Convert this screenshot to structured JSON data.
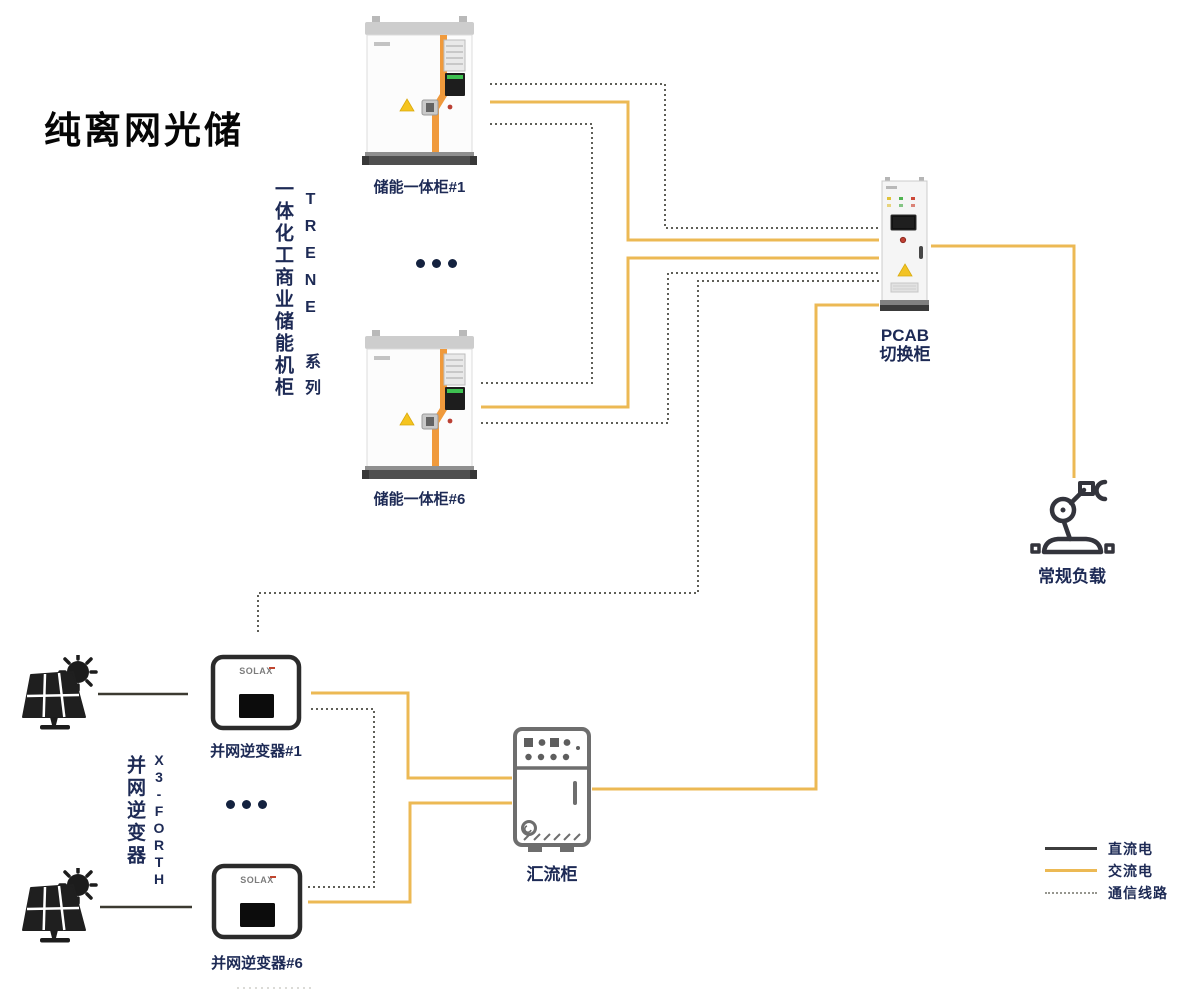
{
  "title": "纯离网光储",
  "colors": {
    "ac": "#ecb954",
    "dc": "#3c3a31",
    "dc_legend": "#3d3d3d",
    "comm": "#5f5f58",
    "comm_legend": "#96968f",
    "navy": "#1d2a55",
    "orange": "#f09a3c"
  },
  "series_blocks": {
    "storage": {
      "name": "一体化工商业储能机柜",
      "series": "TRENE 系列"
    },
    "inverter": {
      "model": "X3-FORTH",
      "name": "并网逆变器"
    }
  },
  "nodes": {
    "storage_cabinet_1": {
      "label": "储能一体柜#1"
    },
    "storage_cabinet_6": {
      "label": "储能一体柜#6"
    },
    "pcab": {
      "label_line1": "PCAB",
      "label_line2": "切换柜"
    },
    "load": {
      "label": "常规负载"
    },
    "combiner": {
      "label": "汇流柜"
    },
    "inverter_1": {
      "label": "并网逆变器#1",
      "brand": "SOLAX"
    },
    "inverter_6": {
      "label": "并网逆变器#6",
      "brand": "SOLAX"
    }
  },
  "legend": {
    "items": [
      {
        "label": "直流电",
        "type": "dc"
      },
      {
        "label": "交流电",
        "type": "ac"
      },
      {
        "label": "通信线路",
        "type": "comm"
      }
    ]
  },
  "connections": [
    {
      "from": "storage_cabinet_1",
      "to": "pcab",
      "type": "comm"
    },
    {
      "from": "storage_cabinet_1",
      "to": "pcab",
      "type": "ac"
    },
    {
      "from": "storage_cabinet_1",
      "to": "storage_cabinet_6",
      "type": "comm"
    },
    {
      "from": "storage_cabinet_6",
      "to": "pcab",
      "type": "ac"
    },
    {
      "from": "storage_cabinet_6",
      "to": "pcab",
      "type": "comm"
    },
    {
      "from": "pcab",
      "to": "inverter_1",
      "type": "comm"
    },
    {
      "from": "inverter_1",
      "to": "inverter_6",
      "type": "comm"
    },
    {
      "from": "pv_array_1",
      "to": "inverter_1",
      "type": "dc"
    },
    {
      "from": "pv_array_2",
      "to": "inverter_6",
      "type": "dc"
    },
    {
      "from": "inverter_1",
      "to": "combiner",
      "type": "ac"
    },
    {
      "from": "inverter_6",
      "to": "combiner",
      "type": "ac"
    },
    {
      "from": "combiner",
      "to": "pcab",
      "type": "ac"
    },
    {
      "from": "pcab",
      "to": "load",
      "type": "ac"
    }
  ]
}
